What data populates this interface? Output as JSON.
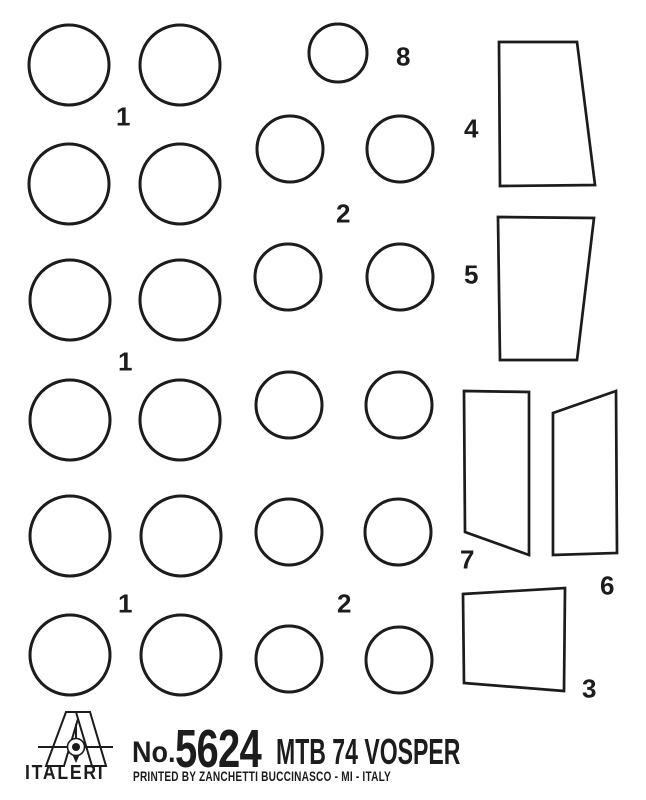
{
  "page": {
    "paper_color": "#ffffff",
    "ink_color": "#1c1c1c"
  },
  "sheet": {
    "circles": [
      {
        "cx": 69,
        "cy": 65,
        "r": 40,
        "size": "large"
      },
      {
        "cx": 180,
        "cy": 65,
        "r": 40,
        "size": "large"
      },
      {
        "cx": 338,
        "cy": 53,
        "r": 29,
        "size": "small"
      },
      {
        "cx": 69,
        "cy": 184,
        "r": 40,
        "size": "large"
      },
      {
        "cx": 180,
        "cy": 184,
        "r": 40,
        "size": "large"
      },
      {
        "cx": 290,
        "cy": 149,
        "r": 33,
        "size": "medium"
      },
      {
        "cx": 400,
        "cy": 149,
        "r": 33,
        "size": "medium"
      },
      {
        "cx": 70,
        "cy": 300,
        "r": 40,
        "size": "large"
      },
      {
        "cx": 180,
        "cy": 300,
        "r": 40,
        "size": "large"
      },
      {
        "cx": 288,
        "cy": 277,
        "r": 33,
        "size": "medium"
      },
      {
        "cx": 400,
        "cy": 277,
        "r": 33,
        "size": "medium"
      },
      {
        "cx": 70,
        "cy": 420,
        "r": 40,
        "size": "large"
      },
      {
        "cx": 180,
        "cy": 420,
        "r": 40,
        "size": "large"
      },
      {
        "cx": 289,
        "cy": 405,
        "r": 33,
        "size": "medium"
      },
      {
        "cx": 399,
        "cy": 405,
        "r": 33,
        "size": "medium"
      },
      {
        "cx": 70,
        "cy": 536,
        "r": 40,
        "size": "large"
      },
      {
        "cx": 181,
        "cy": 536,
        "r": 40,
        "size": "large"
      },
      {
        "cx": 289,
        "cy": 532,
        "r": 33,
        "size": "medium"
      },
      {
        "cx": 398,
        "cy": 532,
        "r": 33,
        "size": "medium"
      },
      {
        "cx": 70,
        "cy": 655,
        "r": 40,
        "size": "large"
      },
      {
        "cx": 181,
        "cy": 655,
        "r": 40,
        "size": "large"
      },
      {
        "cx": 289,
        "cy": 659,
        "r": 33,
        "size": "medium"
      },
      {
        "cx": 399,
        "cy": 660,
        "r": 33,
        "size": "medium"
      }
    ],
    "panels": [
      {
        "part": "4",
        "points": [
          [
            499,
            42
          ],
          [
            577,
            42
          ],
          [
            595,
            185
          ],
          [
            500,
            186
          ]
        ]
      },
      {
        "part": "5",
        "points": [
          [
            498,
            217
          ],
          [
            594,
            218
          ],
          [
            577,
            360
          ],
          [
            500,
            360
          ]
        ]
      },
      {
        "part": "7",
        "points": [
          [
            464,
            391
          ],
          [
            529,
            392
          ],
          [
            529,
            555
          ],
          [
            465,
            532
          ]
        ]
      },
      {
        "part": "6",
        "points": [
          [
            553,
            413
          ],
          [
            616,
            391
          ],
          [
            617,
            553
          ],
          [
            553,
            555
          ]
        ]
      },
      {
        "part": "3",
        "points": [
          [
            463,
            594
          ],
          [
            565,
            588
          ],
          [
            564,
            691
          ],
          [
            464,
            683
          ]
        ]
      }
    ],
    "labels": [
      {
        "text": "1",
        "x": 123,
        "y": 117
      },
      {
        "text": "8",
        "x": 403,
        "y": 57
      },
      {
        "text": "2",
        "x": 343,
        "y": 214
      },
      {
        "text": "4",
        "x": 471,
        "y": 129
      },
      {
        "text": "5",
        "x": 471,
        "y": 275
      },
      {
        "text": "1",
        "x": 125,
        "y": 362
      },
      {
        "text": "1",
        "x": 125,
        "y": 604
      },
      {
        "text": "2",
        "x": 344,
        "y": 604
      },
      {
        "text": "7",
        "x": 467,
        "y": 560
      },
      {
        "text": "6",
        "x": 607,
        "y": 586
      },
      {
        "text": "3",
        "x": 589,
        "y": 689
      }
    ]
  },
  "footer": {
    "brand": "ITALERI",
    "no_label": "No.",
    "kit_number": "5624",
    "kit_title": "MTB 74 VOSPER",
    "printed_line": "PRINTED BY ZANCHETTI BUCCINASCO - MI - ITALY"
  }
}
